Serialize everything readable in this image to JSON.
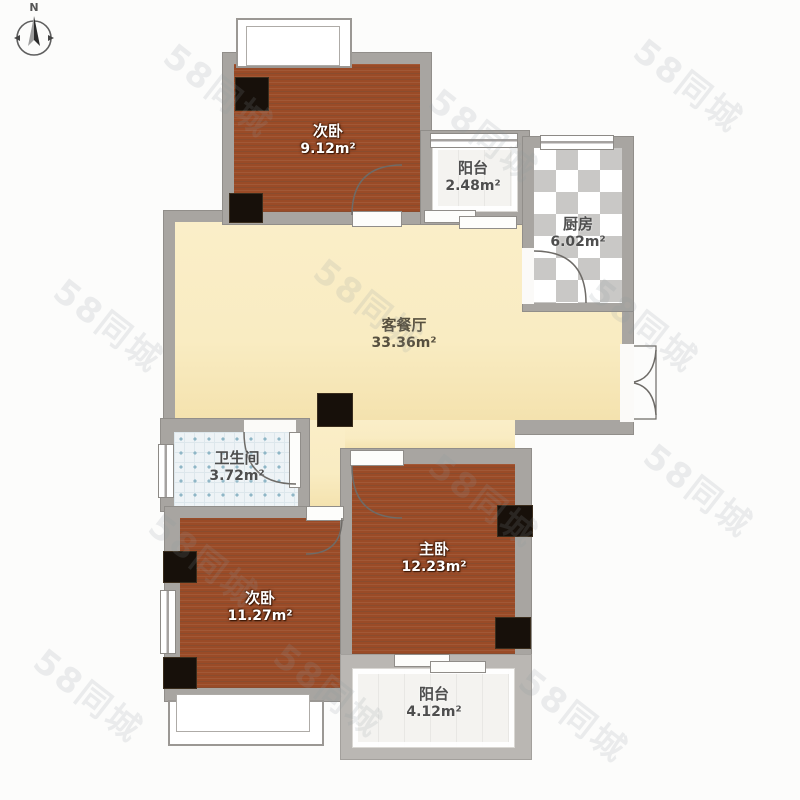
{
  "compass": {
    "north_label": "N"
  },
  "watermark": {
    "text": "58同城"
  },
  "rooms": {
    "bedroom_top": {
      "name": "次卧",
      "area": "9.12m²"
    },
    "balcony_top": {
      "name": "阳台",
      "area": "2.48m²"
    },
    "kitchen": {
      "name": "厨房",
      "area": "6.02m²"
    },
    "living": {
      "name": "客餐厅",
      "area": "33.36m²"
    },
    "bathroom": {
      "name": "卫生间",
      "area": "3.72m²"
    },
    "bedroom_left": {
      "name": "次卧",
      "area": "11.27m²"
    },
    "bedroom_master": {
      "name": "主卧",
      "area": "12.23m²"
    },
    "balcony_bottom": {
      "name": "阳台",
      "area": "4.12m²"
    }
  },
  "colors": {
    "wood_floor": "#9a4b27",
    "living_floor": "#f9ecc2",
    "wall": "#a8a5a1",
    "column": "#17100a",
    "kitchen_tile_gray": "#c9c8c6",
    "bathroom_tile": "#eef3f6",
    "bathroom_dot": "#8fb6c6",
    "balcony_floor": "#f4f3f0",
    "door_stroke": "#6e6b67"
  }
}
